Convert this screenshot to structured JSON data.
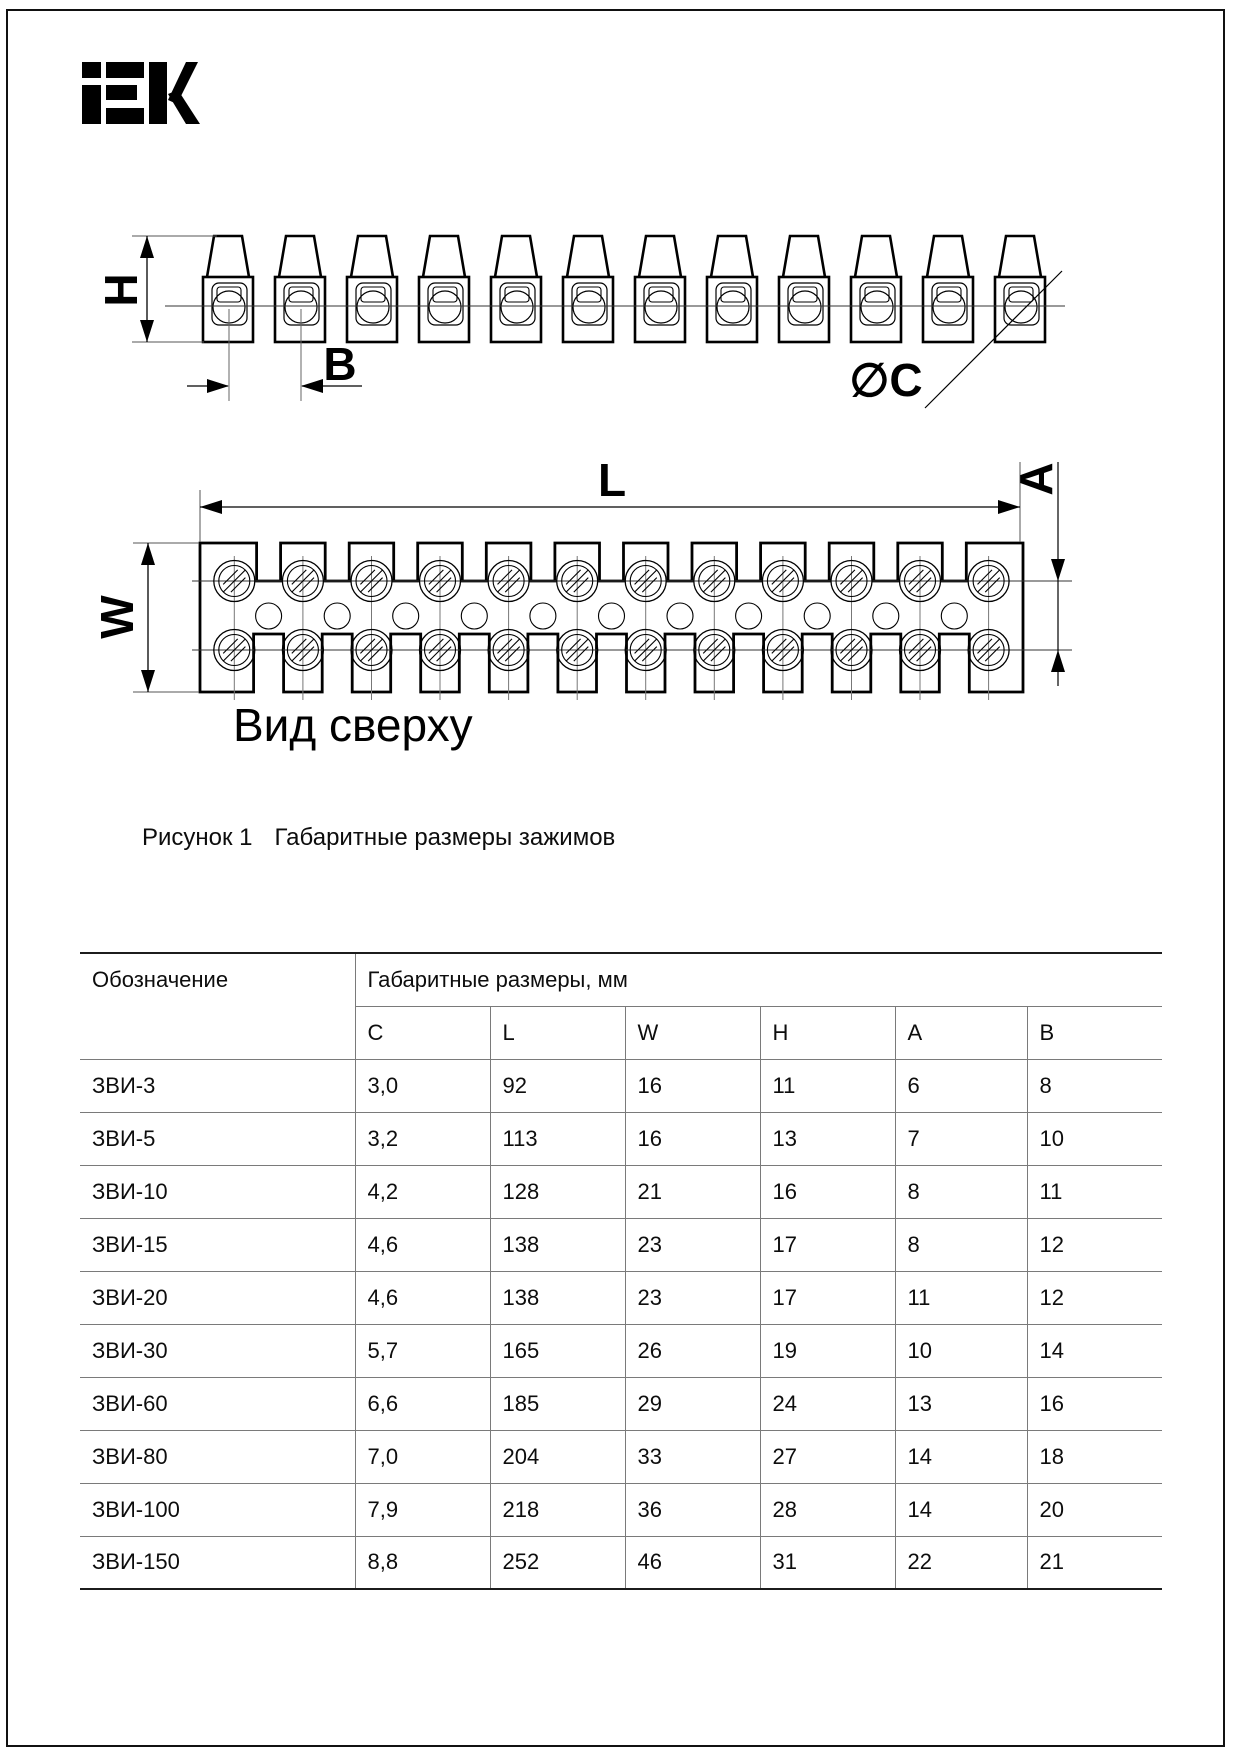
{
  "brand": {
    "text": "IEK"
  },
  "figure": {
    "number_label": "Рисунок 1",
    "caption": "Габаритные размеры зажимов",
    "top_view_label": "Вид сверху",
    "dim_labels": {
      "H": "H",
      "B": "B",
      "C": "∅C",
      "L": "L",
      "W": "W",
      "A": "A"
    },
    "terminal_pairs_shown": 12
  },
  "table": {
    "col_designation": "Обозначение",
    "col_dimensions": "Габаритные размеры, мм",
    "subheaders": [
      "C",
      "L",
      "W",
      "H",
      "A",
      "B"
    ],
    "rows": [
      {
        "name": "ЗВИ-3",
        "values": [
          "3,0",
          "92",
          "16",
          "11",
          "6",
          "8"
        ]
      },
      {
        "name": "ЗВИ-5",
        "values": [
          "3,2",
          "113",
          "16",
          "13",
          "7",
          "10"
        ]
      },
      {
        "name": "ЗВИ-10",
        "values": [
          "4,2",
          "128",
          "21",
          "16",
          "8",
          "11"
        ]
      },
      {
        "name": "ЗВИ-15",
        "values": [
          "4,6",
          "138",
          "23",
          "17",
          "8",
          "12"
        ]
      },
      {
        "name": "ЗВИ-20",
        "values": [
          "4,6",
          "138",
          "23",
          "17",
          "11",
          "12"
        ]
      },
      {
        "name": "ЗВИ-30",
        "values": [
          "5,7",
          "165",
          "26",
          "19",
          "10",
          "14"
        ]
      },
      {
        "name": "ЗВИ-60",
        "values": [
          "6,6",
          "185",
          "29",
          "24",
          "13",
          "16"
        ]
      },
      {
        "name": "ЗВИ-80",
        "values": [
          "7,0",
          "204",
          "33",
          "27",
          "14",
          "18"
        ]
      },
      {
        "name": "ЗВИ-100",
        "values": [
          "7,9",
          "218",
          "36",
          "28",
          "14",
          "20"
        ]
      },
      {
        "name": "ЗВИ-150",
        "values": [
          "8,8",
          "252",
          "46",
          "31",
          "22",
          "21"
        ]
      }
    ]
  },
  "colors": {
    "ink": "#000000",
    "thin_line": "#555555",
    "table_line": "#7a7a7a",
    "table_border": "#1c1c1c"
  }
}
